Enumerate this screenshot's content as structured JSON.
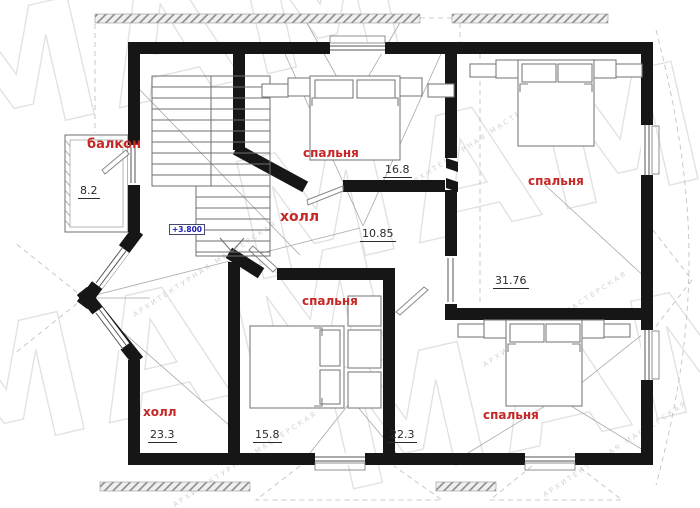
{
  "plan": {
    "drawing_type": "second-floor-plan",
    "elevation_mark": "+3.800",
    "watermark": {
      "letters": "МАМ",
      "tagline": "АРХИТЕКТУРНАЯ МАСТЕРСКАЯ"
    },
    "colors": {
      "wall": "#161616",
      "room_label": "#c62828",
      "area_value": "#2b2b2b",
      "elevation_text": "#1a1aae",
      "watermark": "#e2e2e2"
    },
    "rooms": {
      "balcony": {
        "label": "балкон",
        "area": "8.2"
      },
      "bedroom_top": {
        "label": "спальня",
        "area": "16.8"
      },
      "hall_upper": {
        "label": "холл",
        "area": "10.85"
      },
      "bedroom_right": {
        "label": "спальня",
        "area": "31.76"
      },
      "bedroom_mid": {
        "label": "спальня",
        "area": "15.8"
      },
      "hall_lower": {
        "label": "холл",
        "area": "23.3"
      },
      "bedroom_bottom_right": {
        "label": "спальня",
        "area": "22.3"
      }
    }
  }
}
